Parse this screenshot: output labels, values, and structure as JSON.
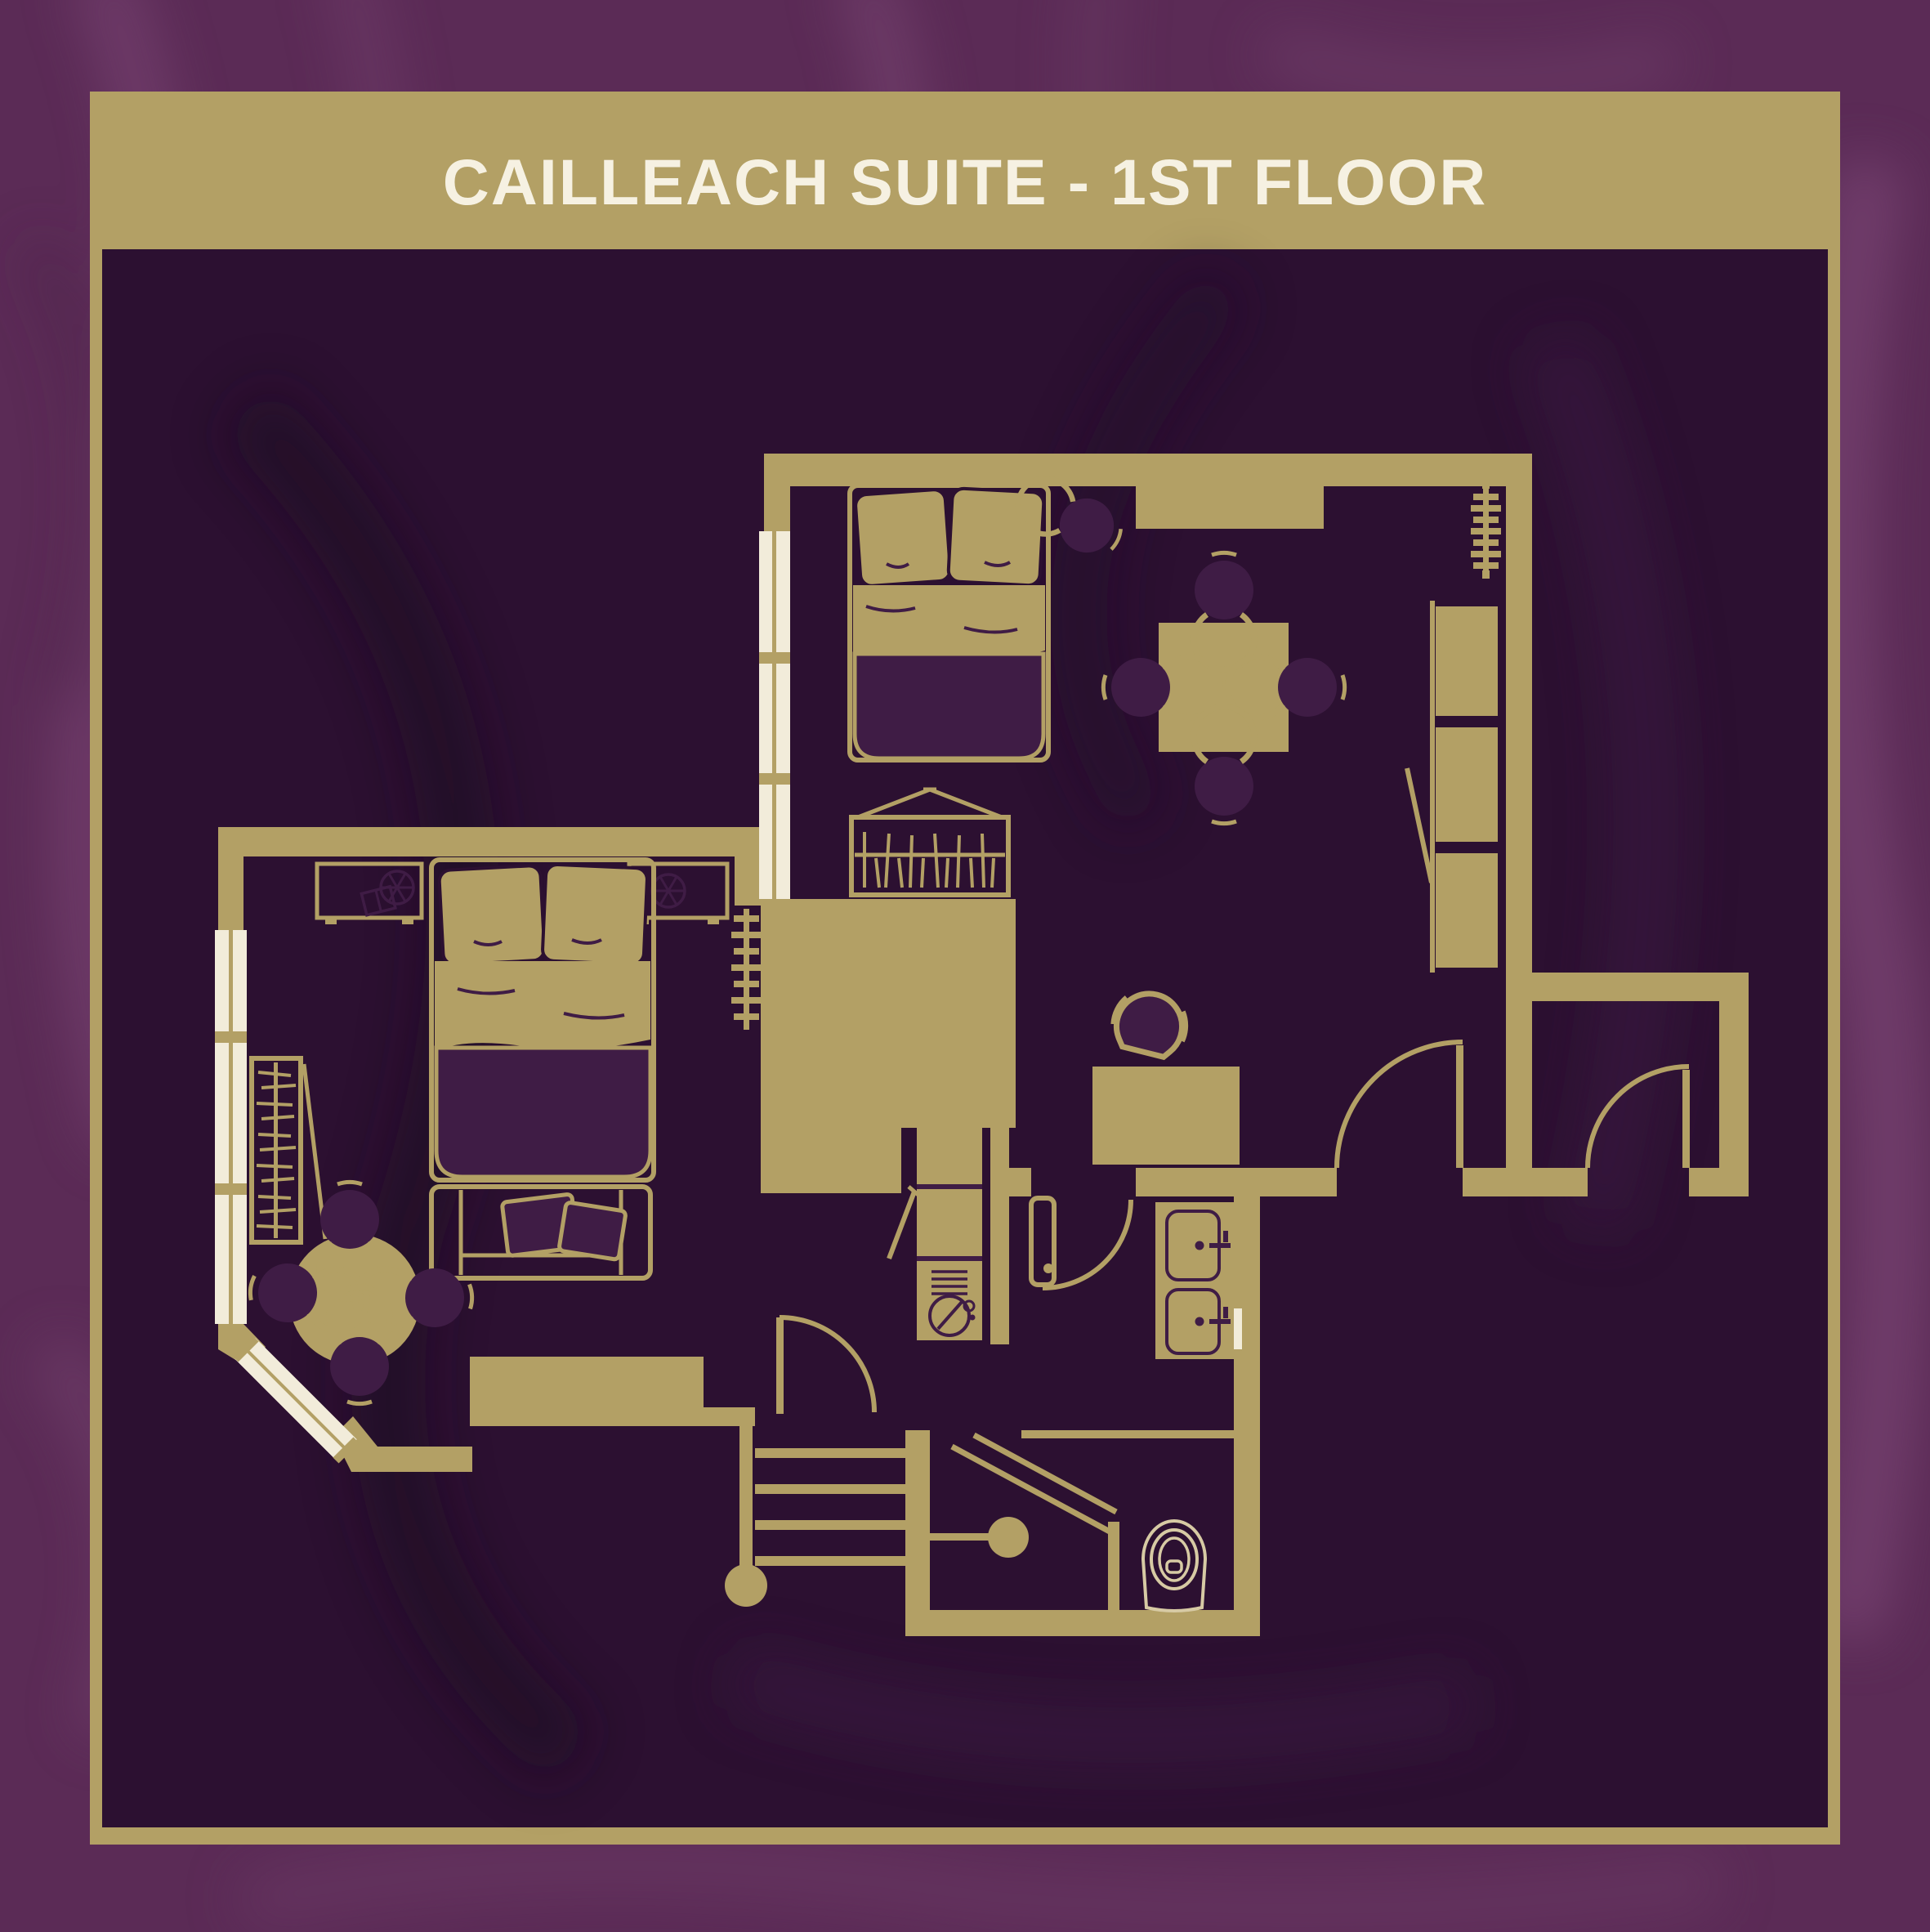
{
  "header": {
    "title": "CAILLEACH SUITE - 1ST FLOOR"
  },
  "colors": {
    "gold": "#b3a065",
    "background_purple": "#5b2b56",
    "panel_purple": "#2c1031",
    "furniture_purple": "#3f1c45",
    "window_white": "#f2ecda",
    "pale_line": "#d7caa4",
    "title_white": "#f6f1e2"
  },
  "floorplan": {
    "icons": [
      "double-bed-icon",
      "pillow-icon",
      "bedside-table-icon",
      "clock-wheel-icon",
      "book-icon",
      "open-wardrobe-hangers-icon",
      "luggage-bench-icon",
      "wardrobe-icon",
      "radiator-icon",
      "dining-table-icon",
      "dining-chair-icon",
      "round-table-icon",
      "stool-icon",
      "desk-icon",
      "desk-chair-icon",
      "sofa-icon",
      "kitchenette-unit-icon",
      "round-sink-icon",
      "vanity-sink-icon",
      "toilet-icon",
      "shower-head-icon",
      "shower-screen-icon",
      "staircase-icon",
      "door-swing-icon",
      "window-icon"
    ]
  }
}
